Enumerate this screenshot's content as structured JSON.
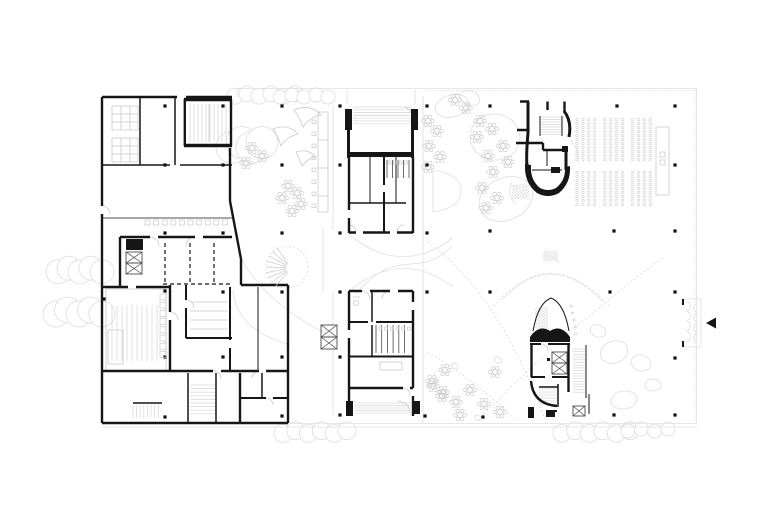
{
  "meta": {
    "description": "Architectural ground floor plan line drawing, black walls on white with light grey furnishing detail",
    "background": "#ffffff"
  },
  "palette": {
    "wall": "#161616",
    "mid": "#4a4a4a",
    "faint": "#c9c9c9",
    "fainter": "#e0e0e0",
    "seat": "#d8d8d8",
    "column": "#111111"
  },
  "entrance_arrow": {
    "points": "706,323 716,317.5 716,328.5",
    "direction": "left"
  },
  "columns": [
    [
      165,
      106
    ],
    [
      223,
      106
    ],
    [
      282,
      106
    ],
    [
      340,
      106
    ],
    [
      427,
      106
    ],
    [
      490,
      106
    ],
    [
      617,
      106
    ],
    [
      675,
      106
    ],
    [
      165,
      165
    ],
    [
      223,
      165
    ],
    [
      282,
      165
    ],
    [
      340,
      165
    ],
    [
      427,
      165
    ],
    [
      675,
      165
    ],
    [
      165,
      233
    ],
    [
      223,
      233
    ],
    [
      282,
      233
    ],
    [
      340,
      233
    ],
    [
      427,
      233
    ],
    [
      490,
      231
    ],
    [
      614,
      231
    ],
    [
      675,
      231
    ],
    [
      104,
      299
    ],
    [
      165,
      291
    ],
    [
      223,
      292
    ],
    [
      282,
      292
    ],
    [
      340,
      292
    ],
    [
      427,
      292
    ],
    [
      490,
      292
    ],
    [
      610,
      292
    ],
    [
      675,
      292
    ],
    [
      165,
      357
    ],
    [
      223,
      357
    ],
    [
      282,
      357
    ],
    [
      340,
      357
    ],
    [
      675,
      358
    ],
    [
      165,
      417
    ],
    [
      282,
      416
    ],
    [
      340,
      415
    ],
    [
      425,
      416
    ],
    [
      483,
      417
    ],
    [
      614,
      415
    ],
    [
      675,
      415
    ]
  ],
  "auditorium": {
    "x0": 577,
    "cols": 12,
    "col_step": 5.9,
    "aisle_after": [
      3,
      7
    ],
    "aisle_gap": 4.2,
    "blocks": [
      {
        "y0": 119.5,
        "rows": 11,
        "row_step": 4.0
      },
      {
        "y0": 172.5,
        "rows": 9,
        "row_step": 4.0
      }
    ],
    "dot_r": 1.25
  },
  "flower_clusters": [
    [
      252,
      148
    ],
    [
      262,
      156
    ],
    [
      246,
      163
    ],
    [
      288,
      186
    ],
    [
      297,
      193
    ],
    [
      282,
      198
    ],
    [
      301,
      204
    ],
    [
      292,
      211
    ],
    [
      455,
      100
    ],
    [
      466,
      108
    ],
    [
      480,
      121
    ],
    [
      492,
      129
    ],
    [
      477,
      137
    ],
    [
      503,
      146
    ],
    [
      488,
      156
    ],
    [
      508,
      162
    ],
    [
      493,
      172
    ],
    [
      482,
      188
    ],
    [
      497,
      198
    ],
    [
      486,
      208
    ],
    [
      428,
      121
    ],
    [
      437,
      131
    ],
    [
      429,
      146
    ],
    [
      440,
      157
    ],
    [
      428,
      167
    ],
    [
      433,
      386
    ],
    [
      442,
      396
    ],
    [
      445,
      370
    ],
    [
      432,
      381
    ],
    [
      443,
      392
    ],
    [
      456,
      402
    ],
    [
      470,
      390
    ],
    [
      484,
      404
    ],
    [
      495,
      372
    ],
    [
      460,
      415
    ],
    [
      500,
      412
    ]
  ],
  "tree_clouds": [
    [
      265,
      95,
      30,
      8,
      6
    ],
    [
      304,
      96,
      24,
      7,
      5
    ],
    [
      247,
      145,
      15,
      16,
      4
    ],
    [
      80,
      270,
      22,
      12,
      5
    ],
    [
      79,
      312,
      23,
      13,
      5
    ],
    [
      315,
      432,
      32,
      9,
      6
    ],
    [
      596,
      432,
      34,
      9,
      6
    ],
    [
      648,
      430,
      20,
      7,
      4
    ]
  ],
  "blobs": [
    [
      452,
      106,
      17,
      11,
      -15
    ],
    [
      495,
      137,
      25,
      23,
      10
    ],
    [
      506,
      199,
      28,
      21,
      -25
    ],
    [
      470,
      98,
      10,
      7,
      20
    ],
    [
      614,
      352,
      14,
      11,
      -20
    ],
    [
      641,
      363,
      10,
      8,
      15
    ],
    [
      624,
      400,
      13,
      9,
      -8
    ],
    [
      653,
      385,
      8,
      6,
      0
    ],
    [
      598,
      331,
      8,
      6,
      20
    ],
    [
      455,
      366,
      3.5,
      2.5,
      45
    ],
    [
      498,
      360,
      4,
      3,
      30
    ],
    [
      478,
      418,
      3.5,
      2.5,
      20
    ]
  ],
  "xboxes": [
    [
      126,
      252,
      16,
      11
    ],
    [
      126,
      263,
      16,
      11
    ],
    [
      321,
      325,
      16,
      12
    ],
    [
      321,
      337,
      16,
      12
    ],
    [
      552,
      352,
      15,
      11
    ],
    [
      552,
      363,
      15,
      11
    ],
    [
      573,
      406,
      12,
      10
    ]
  ],
  "small_squares": [
    {
      "x": 145,
      "y": 220,
      "n": 10,
      "step": 8.6,
      "size": 5,
      "dir": "h"
    },
    {
      "x": 312,
      "y": 120,
      "n": 8,
      "step": 12,
      "size": 3.5,
      "dir": "v"
    },
    {
      "x": 160,
      "y": 294,
      "n": 8,
      "step": 8.2,
      "size": 6,
      "dir": "v"
    },
    {
      "x": 379,
      "y": 327,
      "n": 6,
      "step": 5.7,
      "size": 3,
      "dir": "h"
    },
    {
      "x": 388,
      "y": 161,
      "n": 4,
      "step": 5.5,
      "size": 3,
      "dir": "h"
    }
  ],
  "fans": [
    {
      "cx": 291,
      "cy": 268,
      "r0": 5,
      "r1": 25,
      "a0": 130,
      "a1": 235,
      "n": 9
    }
  ],
  "small_dots": [
    [
      571,
      306
    ],
    [
      572.5,
      313
    ],
    [
      574,
      320
    ],
    [
      575,
      327
    ],
    [
      575.5,
      334
    ]
  ]
}
